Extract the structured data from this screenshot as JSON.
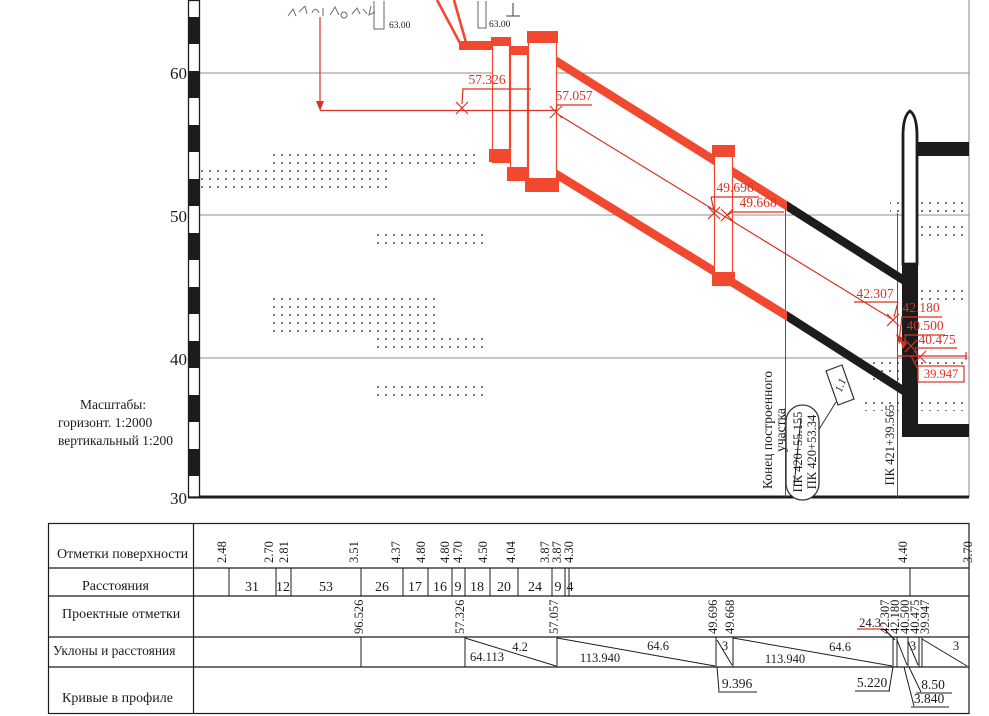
{
  "scales_note": {
    "title": "Масштабы:",
    "horizontal": "горизонт. 1:2000",
    "vertical": "вертикальный 1:200"
  },
  "axis_ticks": [
    "60",
    "50",
    "40",
    "30"
  ],
  "drawing": {
    "bench1": "63.00",
    "bench2": "63.00",
    "marks": {
      "m1": "57.326",
      "m2": "57.057",
      "m3": "49.696",
      "m4": "49.668",
      "m5": "42.307",
      "m6": "42.180",
      "m7": "40.500",
      "m8": "40.475",
      "m9": "39.947"
    },
    "flag": "1.1",
    "end_line1": "Конец построенного",
    "end_line2": "участка",
    "pk_struck": "ПК 420+55.155",
    "pk_new": "ПК 420+53.34",
    "pk_station": "ПК 421+39.565"
  },
  "table": {
    "headers": [
      "Отметки поверхности",
      "Расстояния",
      "Проектные отметки",
      "Уклоны и расстояния",
      "Кривые в профиле"
    ],
    "surface": [
      "2.48",
      "2.70",
      "2.81",
      "3.51",
      "4.37",
      "4.80",
      "4.80",
      "4.70",
      "4.50",
      "4.04",
      "3.87",
      "3.87",
      "4.30",
      "4.40",
      "3.70"
    ],
    "distances": [
      "31",
      "12",
      "53",
      "26",
      "17",
      "16",
      "9",
      "18",
      "20",
      "24",
      "9",
      "4"
    ],
    "design": [
      "96.526",
      "57.326",
      "57.057",
      "49.696",
      "49.668",
      "42.307",
      "42.180",
      "40.500",
      "40.475",
      "39.947"
    ],
    "design_note": "24.3",
    "slopes": [
      "64.113",
      "4.2",
      "113.940",
      "64.6",
      "3",
      "113.940",
      "64.6",
      "3",
      "3"
    ],
    "curves": [
      "9.396",
      "5.220",
      "8.50",
      "3.840"
    ]
  },
  "colors": {
    "red": "#d93222",
    "band_red": "#f0492f",
    "black": "#1c1c1c",
    "grid": "#8f8f8f"
  }
}
